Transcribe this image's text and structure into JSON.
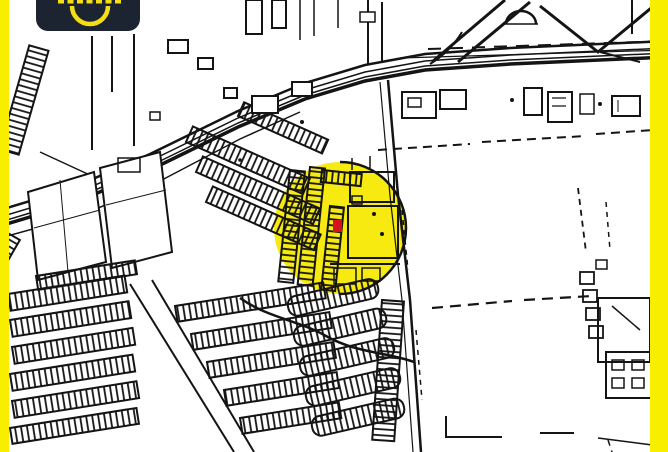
{
  "page": {
    "type": "map-screenshot"
  },
  "colors": {
    "frame": "#F8EE00",
    "map_bg": "#FFFFFF",
    "map_ink": "#141414",
    "highlight": "#F6EA10",
    "marker": "#D8101B",
    "logo_bg": "#1B2430",
    "logo_accent": "#F6DE17"
  },
  "map": {
    "style": "black-and-white cadastral street map",
    "highlight_shape": "circle",
    "marker_shape": "small red rectangle",
    "marker_color": "#D8101B",
    "highlight_color": "#F6EA10"
  },
  "logo": {
    "icon_name": "smile-arc-icon",
    "text_cropped": true
  }
}
